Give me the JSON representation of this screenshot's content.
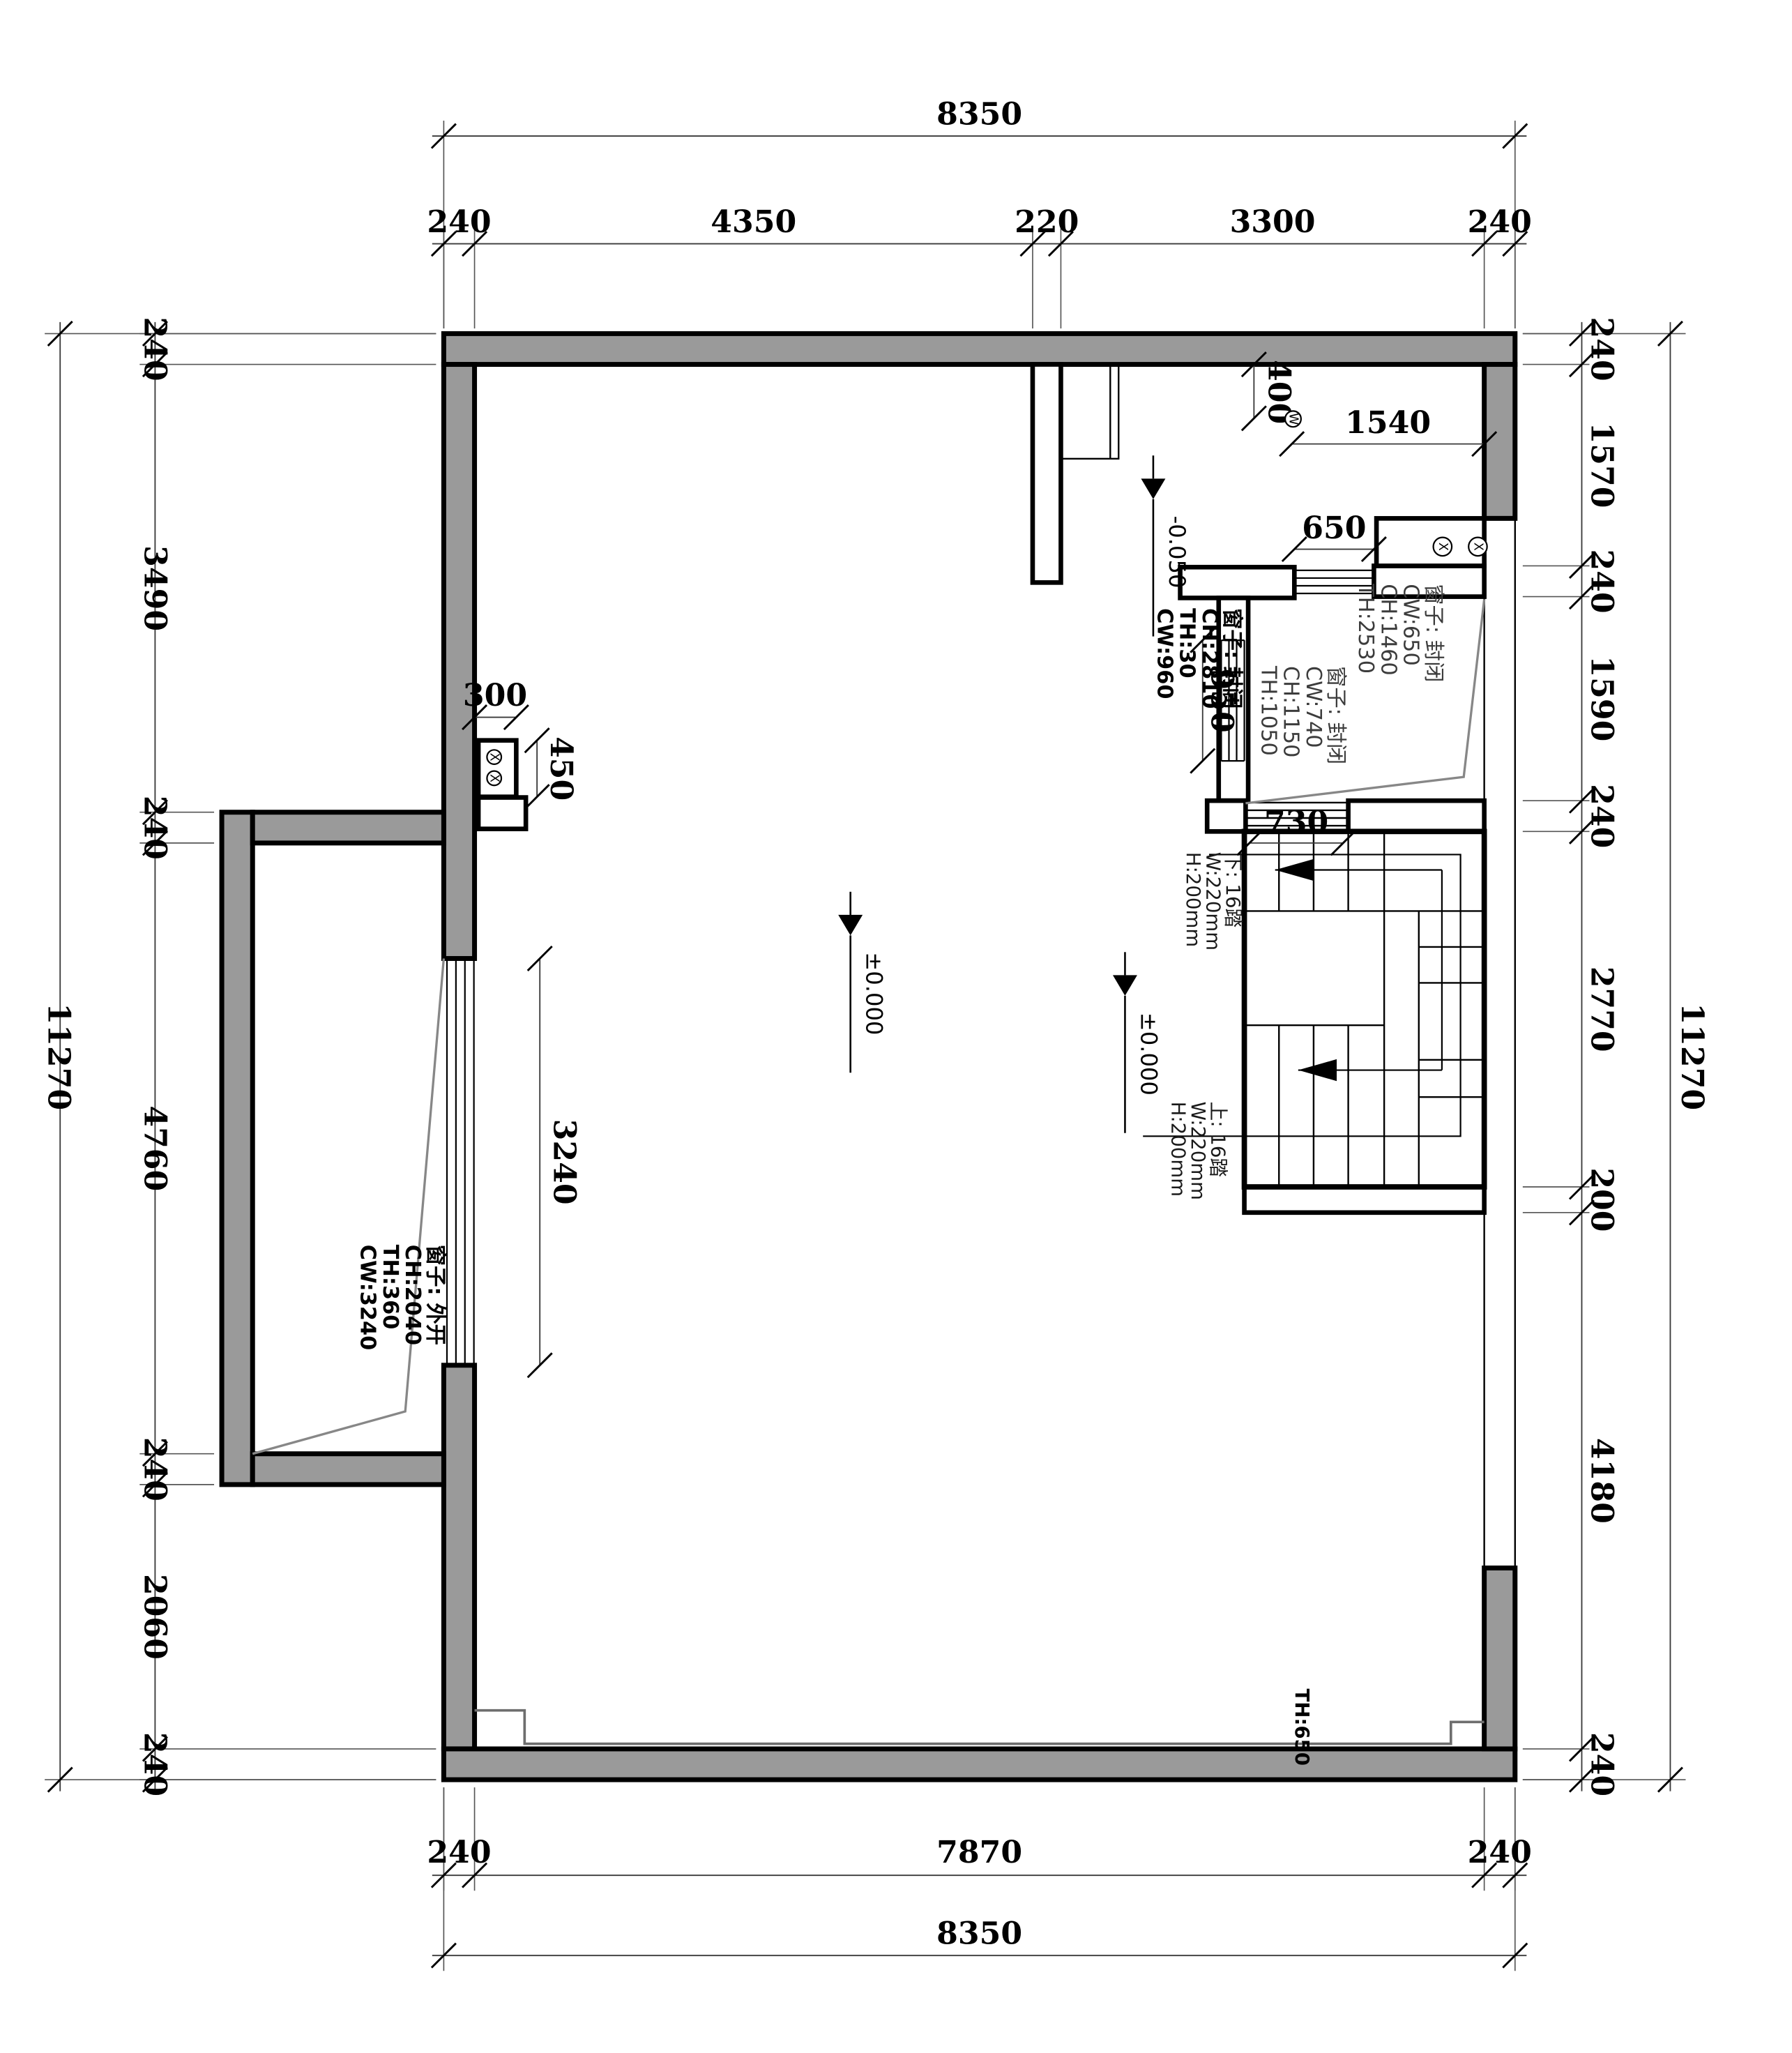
{
  "drawing": {
    "type": "architectural-floor-plan",
    "colors": {
      "wall_fill": "#9a9a9a",
      "outline": "#000000",
      "swing_line": "#878787",
      "background": "#ffffff"
    },
    "dims": {
      "top_total": "8350",
      "top_chain": [
        "240",
        "4350",
        "220",
        "3300",
        "240"
      ],
      "bottom_chain": [
        "240",
        "7870",
        "240"
      ],
      "bottom_total": "8350",
      "left_total": "11270",
      "left_chain": [
        "240",
        "3490",
        "240",
        "4760",
        "240",
        "2060",
        "240"
      ],
      "right_chain": [
        "240",
        "1570",
        "240",
        "1590",
        "240",
        "2770",
        "200",
        "4180",
        "240"
      ],
      "right_total": "11270",
      "interior": {
        "d400": "400",
        "d1540": "1540",
        "d650": "650",
        "d950": "950",
        "d730": "730",
        "d300": "300",
        "d450": "450",
        "d3240": "3240"
      }
    },
    "levels": {
      "entry": "-0.050",
      "main": "±0.000",
      "stair": "±0.000"
    },
    "windows": {
      "w1": [
        "窗子: 封闭",
        "CH:2810",
        "TH:30",
        "CW:960"
      ],
      "w2": [
        "窗子: 封闭",
        "CW:740",
        "CH:1150",
        "TH:1050"
      ],
      "w3": [
        "窗子: 封闭",
        "CW:650",
        "CH:1460",
        "TH:2530"
      ],
      "w4": [
        "窗子: 外开",
        "CH:2040",
        "TH:360",
        "CW:3240"
      ]
    },
    "stairs": {
      "down": [
        "下: 16踏",
        "W:220mm",
        "H:200mm"
      ],
      "up": [
        "上: 16踏",
        "W:220mm",
        "H:200mm"
      ]
    },
    "symbols": {
      "w": "W",
      "x": "X",
      "threshold": "TH:650"
    }
  }
}
